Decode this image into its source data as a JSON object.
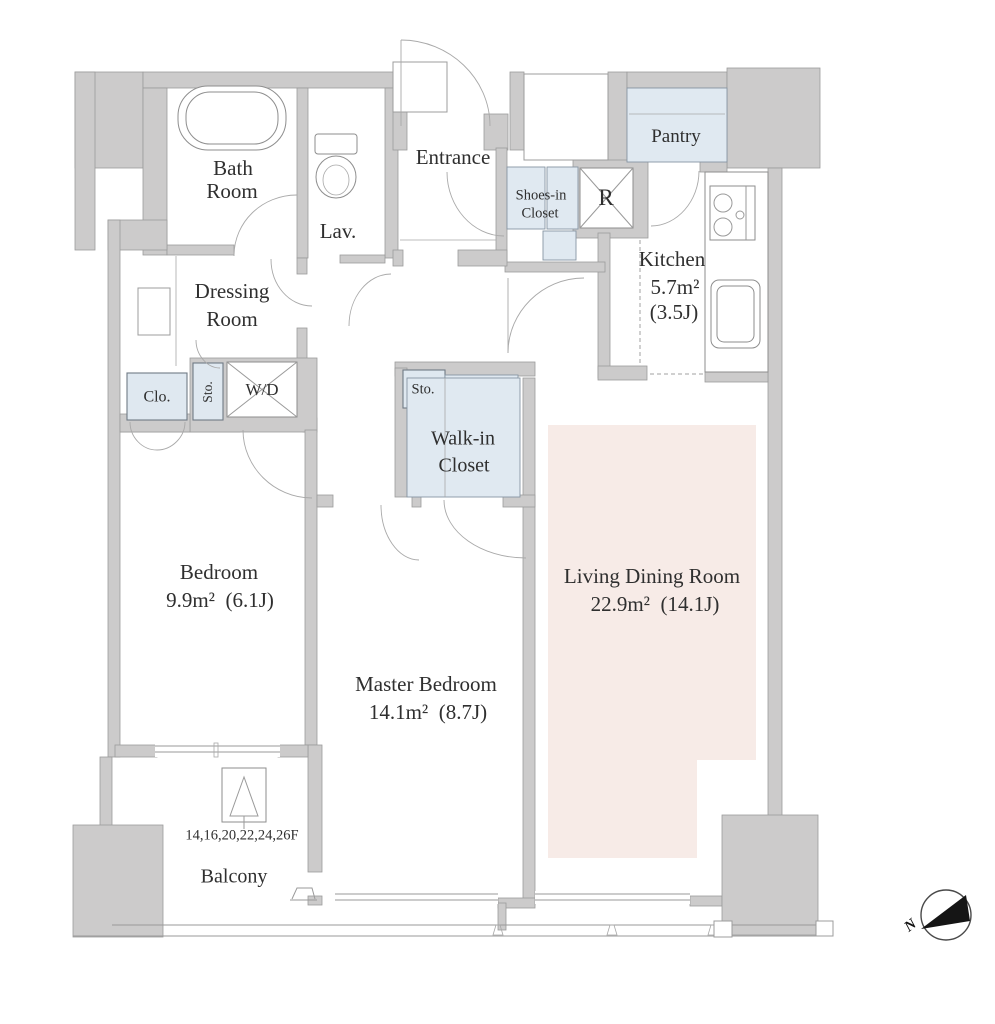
{
  "title": "Apartment floor plan",
  "colors": {
    "wall": "#cccbcb",
    "wall_border": "#9c9c9c",
    "closet_blue": "#e0e9f1",
    "ldk_pink": "#f7ebe7",
    "line": "#9a9a9a",
    "text": "#2f2f2f",
    "compass_black": "#151515"
  },
  "rooms": {
    "bath": {
      "line1": "Bath",
      "line2": "Room"
    },
    "lav": {
      "label": "Lav."
    },
    "entrance": {
      "label": "Entrance"
    },
    "shoes_in_closet": {
      "line1": "Shoes-in",
      "line2": "Closet"
    },
    "refrigerator": {
      "label": "R"
    },
    "pantry": {
      "label": "Pantry"
    },
    "kitchen": {
      "label": "Kitchen",
      "area": "5.7m²",
      "tatami": "(3.5J)"
    },
    "dressing": {
      "line1": "Dressing",
      "line2": "Room"
    },
    "closet": {
      "label": "Clo."
    },
    "storage1": {
      "label": "Sto."
    },
    "washer_dryer": {
      "label": "W/D"
    },
    "storage2": {
      "label": "Sto."
    },
    "walk_in_closet": {
      "line1": "Walk-in",
      "line2": "Closet"
    },
    "bedroom": {
      "label": "Bedroom",
      "area": "9.9m²  (6.1J)"
    },
    "master_bedroom": {
      "label": "Master Bedroom",
      "area": "14.1m²  (8.7J)"
    },
    "living_dining": {
      "label": "Living Dining Room",
      "area": "22.9m²  (14.1J)"
    },
    "balcony": {
      "label": "Balcony",
      "floors": "14,16,20,22,24,26F"
    }
  },
  "compass": {
    "north": "N"
  }
}
